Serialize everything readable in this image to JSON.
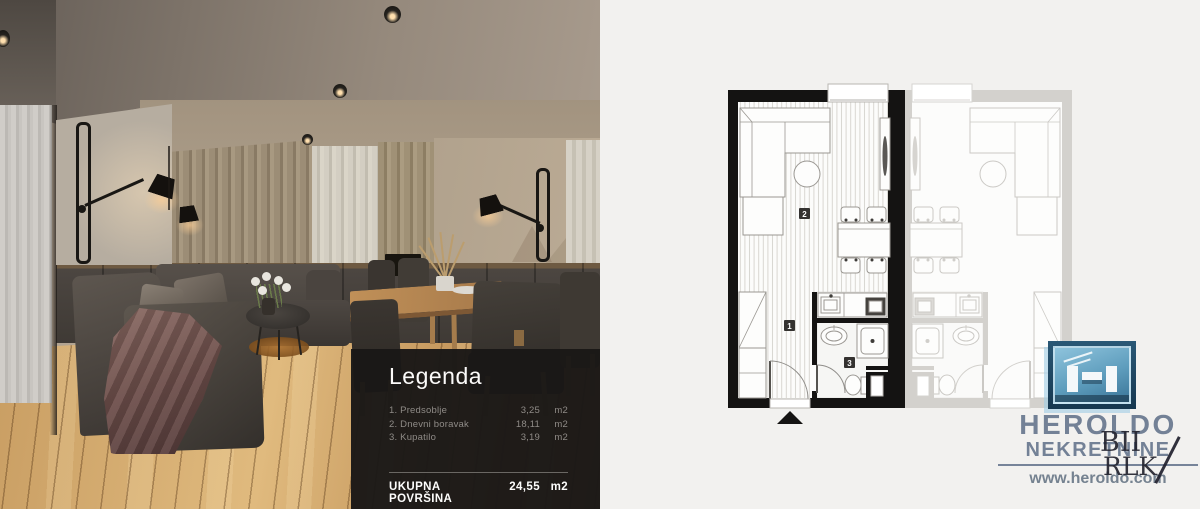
{
  "legend": {
    "title": "Legenda",
    "rows": [
      {
        "name": "1. Predsoblje",
        "value": "3,25",
        "unit": "m2"
      },
      {
        "name": "2. Dnevni boravak",
        "value": "18,11",
        "unit": "m2"
      },
      {
        "name": "3. Kupatilo",
        "value": "3,19",
        "unit": "m2"
      }
    ],
    "total_label": "UKUPNA POVRŠINA",
    "total_value": "24,55",
    "total_unit": "m2",
    "panel_color": "#1a1817"
  },
  "plan": {
    "room_labels": {
      "hall": "1",
      "living": "2",
      "bath": "3"
    },
    "wall_color": "#141312",
    "neighbour_unit_color": "#d3d1cd"
  },
  "branding": {
    "name_line1": "HEROLDO",
    "name_line2": "NEKRETNINE",
    "website": "www.heroldo.com",
    "watermark_line1": "BII",
    "watermark_line2": "RLK",
    "logo_icon": "building-h-icon",
    "colors": {
      "logo_frame_blue": "#16374f",
      "logo_panel_blue": "#5e9dbd",
      "brand_text": "#61718a"
    }
  }
}
